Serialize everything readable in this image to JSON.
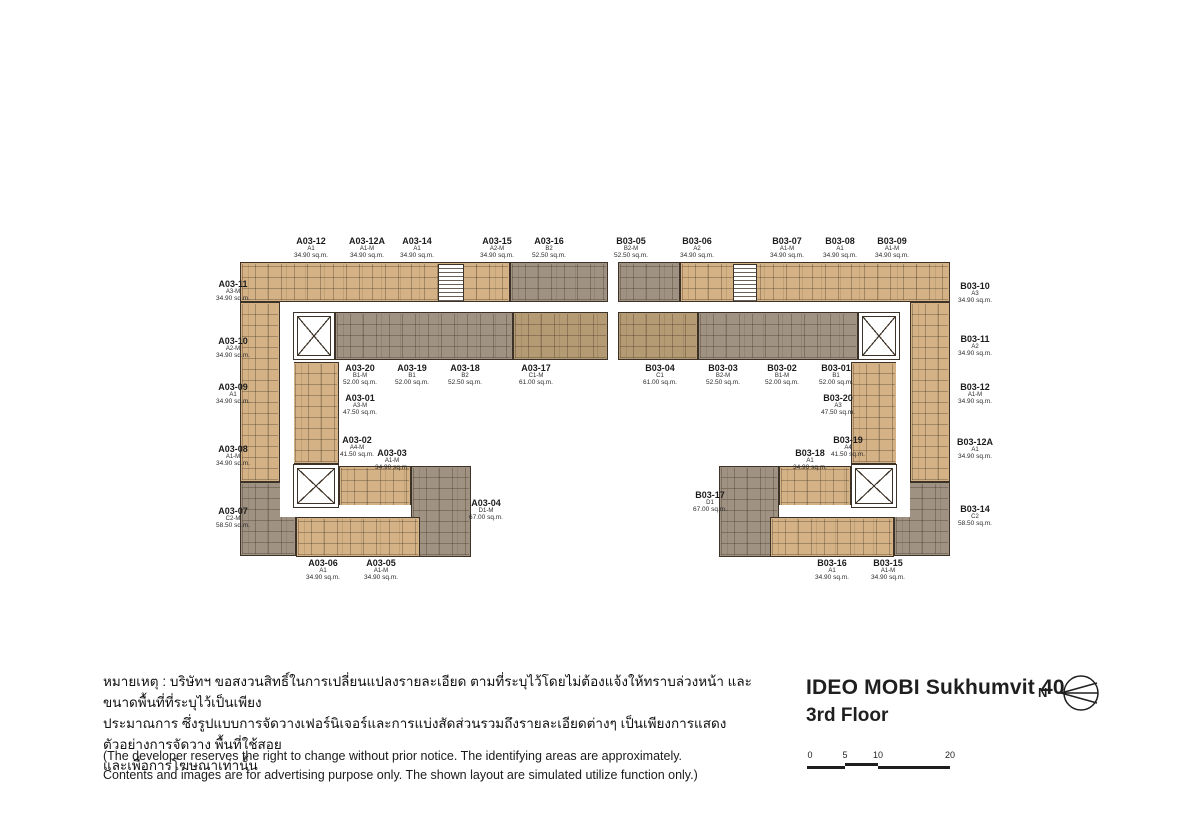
{
  "title": {
    "project": "IDEO MOBI Sukhumvit 40",
    "floor": "3rd Floor"
  },
  "compass": {
    "label": "N"
  },
  "scale_bar": {
    "ticks": [
      "0",
      "5",
      "10",
      "20"
    ]
  },
  "notes": {
    "thai_lines": [
      "หมายเหตุ : บริษัทฯ ขอสงวนสิทธิ์ในการเปลี่ยนแปลงรายละเอียด ตามที่ระบุไว้โดยไม่ต้องแจ้งให้ทราบล่วงหน้า และขนาดพื้นที่ที่ระบุไว้เป็นเพียง",
      "ประมาณการ ซึ่งรูปแบบการจัดวางเฟอร์นิเจอร์และการแบ่งสัดส่วนรวมถึงรายละเอียดต่างๆ เป็นเพียงการแสดงตัวอย่างการจัดวาง พื้นที่ใช้สอย",
      "และเพื่อการโฆษณาเท่านั้น"
    ],
    "english_lines": [
      "(The developer reserves the right to change without prior notice. The identifying areas are approximately.",
      "Contents and images are for advertising purpose only. The shown layout are simulated utilize function only.)"
    ]
  },
  "colors": {
    "unit_beige": "#d4b285",
    "unit_gray": "#a09282",
    "unit_brown": "#b59b74",
    "wall": "#3d3227"
  },
  "buildings": [
    {
      "name": "Building A",
      "units": [
        {
          "id": "A03-12",
          "type": "A1",
          "area": "34.90 sq.m."
        },
        {
          "id": "A03-12A",
          "type": "A1-M",
          "area": "34.90 sq.m."
        },
        {
          "id": "A03-14",
          "type": "A1",
          "area": "34.90 sq.m."
        },
        {
          "id": "A03-15",
          "type": "A2-M",
          "area": "34.90 sq.m."
        },
        {
          "id": "A03-16",
          "type": "B2",
          "area": "52.50 sq.m."
        },
        {
          "id": "A03-11",
          "type": "A3-M",
          "area": "34.90 sq.m."
        },
        {
          "id": "A03-10",
          "type": "A2-M",
          "area": "34.90 sq.m."
        },
        {
          "id": "A03-09",
          "type": "A1",
          "area": "34.90 sq.m."
        },
        {
          "id": "A03-08",
          "type": "A1-M",
          "area": "34.90 sq.m."
        },
        {
          "id": "A03-07",
          "type": "C2-M",
          "area": "58.50 sq.m."
        },
        {
          "id": "A03-20",
          "type": "B1-M",
          "area": "52.00 sq.m."
        },
        {
          "id": "A03-19",
          "type": "B1",
          "area": "52.00 sq.m."
        },
        {
          "id": "A03-18",
          "type": "B2",
          "area": "52.50 sq.m."
        },
        {
          "id": "A03-17",
          "type": "C1-M",
          "area": "61.00 sq.m."
        },
        {
          "id": "A03-01",
          "type": "A3-M",
          "area": "47.50 sq.m."
        },
        {
          "id": "A03-02",
          "type": "A4-M",
          "area": "41.50 sq.m."
        },
        {
          "id": "A03-03",
          "type": "A1-M",
          "area": "34.90 sq.m."
        },
        {
          "id": "A03-04",
          "type": "D1-M",
          "area": "67.00 sq.m."
        },
        {
          "id": "A03-06",
          "type": "A1",
          "area": "34.90 sq.m."
        },
        {
          "id": "A03-05",
          "type": "A1-M",
          "area": "34.90 sq.m."
        }
      ]
    },
    {
      "name": "Building B",
      "units": [
        {
          "id": "B03-05",
          "type": "B2-M",
          "area": "52.50 sq.m."
        },
        {
          "id": "B03-06",
          "type": "A2",
          "area": "34.90 sq.m."
        },
        {
          "id": "B03-07",
          "type": "A1-M",
          "area": "34.90 sq.m."
        },
        {
          "id": "B03-08",
          "type": "A1",
          "area": "34.90 sq.m."
        },
        {
          "id": "B03-09",
          "type": "A1-M",
          "area": "34.90 sq.m."
        },
        {
          "id": "B03-10",
          "type": "A3",
          "area": "34.90 sq.m."
        },
        {
          "id": "B03-11",
          "type": "A2",
          "area": "34.90 sq.m."
        },
        {
          "id": "B03-12",
          "type": "A1-M",
          "area": "34.90 sq.m."
        },
        {
          "id": "B03-12A",
          "type": "A1",
          "area": "34.90 sq.m."
        },
        {
          "id": "B03-14",
          "type": "C2",
          "area": "58.50 sq.m."
        },
        {
          "id": "B03-04",
          "type": "C1",
          "area": "61.00 sq.m."
        },
        {
          "id": "B03-03",
          "type": "B2-M",
          "area": "52.50 sq.m."
        },
        {
          "id": "B03-02",
          "type": "B1-M",
          "area": "52.00 sq.m."
        },
        {
          "id": "B03-01",
          "type": "B1",
          "area": "52.00 sq.m."
        },
        {
          "id": "B03-20",
          "type": "A3",
          "area": "47.50 sq.m."
        },
        {
          "id": "B03-19",
          "type": "A4",
          "area": "41.50 sq.m."
        },
        {
          "id": "B03-18",
          "type": "A1",
          "area": "34.90 sq.m."
        },
        {
          "id": "B03-17",
          "type": "D1",
          "area": "67.00 sq.m."
        },
        {
          "id": "B03-16",
          "type": "A1",
          "area": "34.90 sq.m."
        },
        {
          "id": "B03-15",
          "type": "A1-M",
          "area": "34.90 sq.m."
        }
      ]
    }
  ]
}
